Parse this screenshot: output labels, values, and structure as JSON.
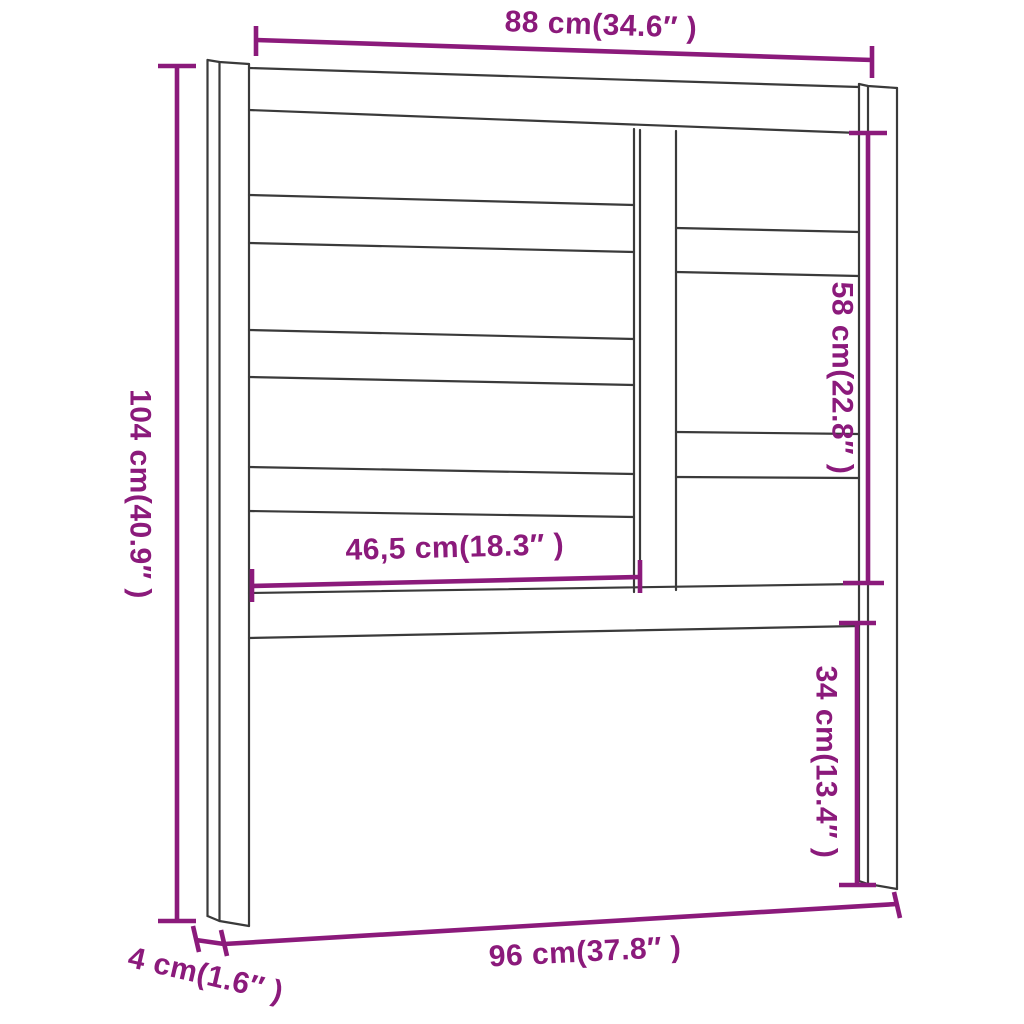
{
  "diagram": {
    "type": "furniture-dimension-drawing",
    "subject": "slatted headboard",
    "background_color": "#ffffff",
    "outline_color": "#3a3a3a",
    "dimension_color": "#8B1A7B",
    "dimensions": {
      "top_width": {
        "label": "88 cm(34.6″ )",
        "value_cm": 88,
        "value_in": 34.6
      },
      "left_height": {
        "label": "104 cm(40.9″ )",
        "value_cm": 104,
        "value_in": 40.9
      },
      "right_upper_height": {
        "label": "58 cm(22.8″ )",
        "value_cm": 58,
        "value_in": 22.8
      },
      "middle_width": {
        "label": "46,5 cm(18.3″ )",
        "value_cm": 46.5,
        "value_in": 18.3
      },
      "right_lower_height": {
        "label": "34 cm(13.4″ )",
        "value_cm": 34,
        "value_in": 13.4
      },
      "bottom_width": {
        "label": "96 cm(37.8″ )",
        "value_cm": 96,
        "value_in": 37.8
      },
      "leg_depth": {
        "label": "4 cm(1.6″ )",
        "value_cm": 4,
        "value_in": 1.6
      }
    }
  }
}
